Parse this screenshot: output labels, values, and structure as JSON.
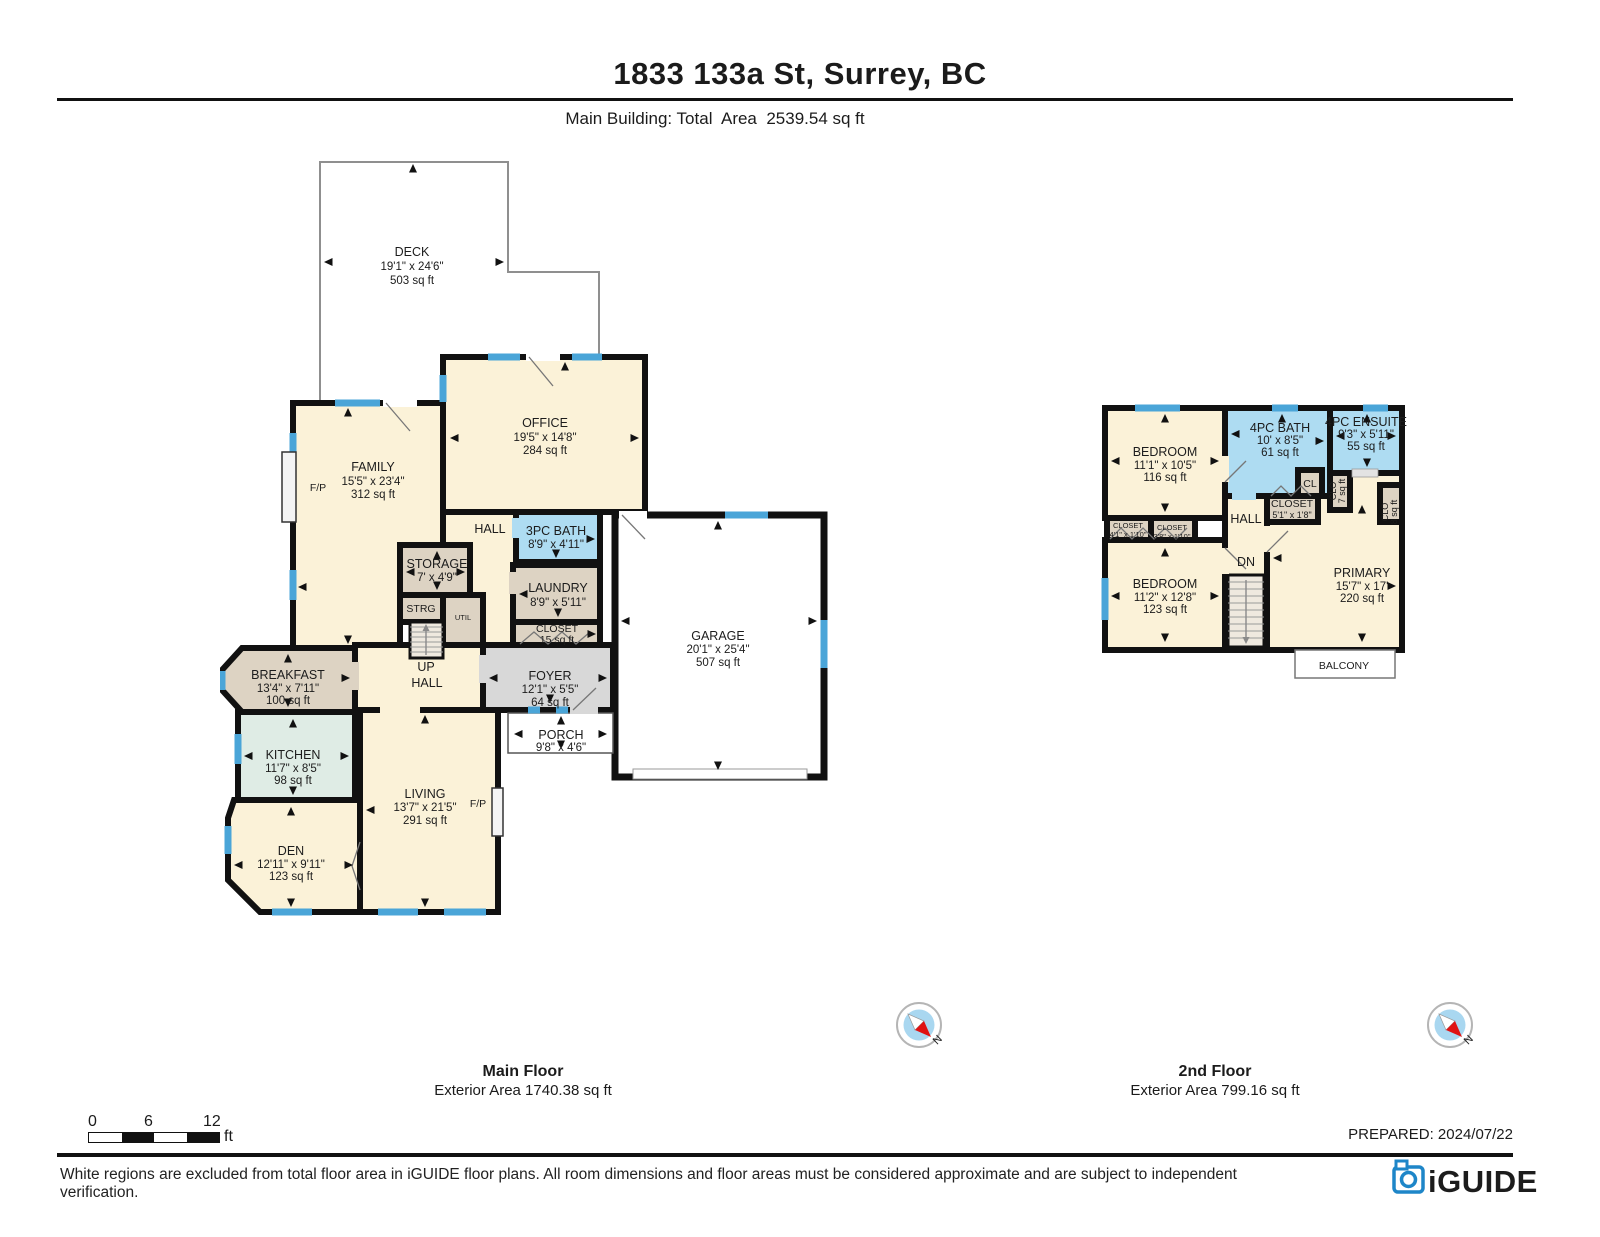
{
  "header": {
    "title": "1833 133a St, Surrey, BC",
    "subtitle": "Main Building: Total  Area  2539.54 sq ft"
  },
  "main_floor": {
    "title": "Main Floor",
    "area": "Exterior Area 1740.38 sq ft",
    "rooms": {
      "deck": {
        "name": "DECK",
        "dims": "19'1\" x 24'6\"",
        "area": "503 sq ft"
      },
      "office": {
        "name": "OFFICE",
        "dims": "19'5\" x 14'8\"",
        "area": "284 sq ft"
      },
      "family": {
        "name": "FAMILY",
        "dims": "15'5\" x 23'4\"",
        "area": "312 sq ft"
      },
      "hall_upper": {
        "name": "HALL"
      },
      "bath3pc": {
        "name": "3PC BATH",
        "dims": "8'9\" x 4'11\""
      },
      "storage": {
        "name": "STORAGE",
        "dims": "7' x 4'9\""
      },
      "laundry": {
        "name": "LAUNDRY",
        "dims": "8'9\" x 5'11\""
      },
      "strg": {
        "name": "STRG"
      },
      "util": {
        "name": "UTIL"
      },
      "closet": {
        "name": "CLOSET",
        "area": "15 sq ft"
      },
      "up": {
        "name": "UP"
      },
      "hall_lower": {
        "name": "HALL"
      },
      "foyer": {
        "name": "FOYER",
        "dims": "12'1\" x 5'5\"",
        "area": "64 sq ft"
      },
      "breakfast": {
        "name": "BREAKFAST",
        "dims": "13'4\" x 7'11\"",
        "area": "100 sq ft"
      },
      "porch": {
        "name": "PORCH",
        "dims": "9'8\" x 4'6\""
      },
      "garage": {
        "name": "GARAGE",
        "dims": "20'1\" x 25'4\"",
        "area": "507 sq ft"
      },
      "kitchen": {
        "name": "KITCHEN",
        "dims": "11'7\" x 8'5\"",
        "area": "98 sq ft"
      },
      "living": {
        "name": "LIVING",
        "dims": "13'7\" x 21'5\"",
        "area": "291 sq ft"
      },
      "den": {
        "name": "DEN",
        "dims": "12'11\" x 9'11\"",
        "area": "123 sq ft"
      },
      "fp_family": {
        "name": "F/P"
      },
      "fp_living": {
        "name": "F/P"
      }
    }
  },
  "second_floor": {
    "title": "2nd Floor",
    "area": "Exterior Area 799.16 sq ft",
    "rooms": {
      "bedroom1": {
        "name": "BEDROOM",
        "dims": "11'1\" x 10'5\"",
        "area": "116 sq ft"
      },
      "bath4pc": {
        "name": "4PC BATH",
        "dims": "10' x 8'5\"",
        "area": "61 sq ft"
      },
      "ensuite": {
        "name": "4PC ENSUITE",
        "dims": "9'3\" x 5'11\"",
        "area": "55 sq ft"
      },
      "cl": {
        "name": "CL"
      },
      "clo7": {
        "name": "CLO",
        "area": "7 sq ft"
      },
      "closet_hall": {
        "name": "CLOSET",
        "dims": "5'1\" x 1'8\""
      },
      "hall": {
        "name": "HALL"
      },
      "closet41": {
        "name": "CLOSET",
        "dims": "4'1\" x 1'10\""
      },
      "closet38": {
        "name": "CLOSET",
        "dims": "3'8\" x 1'10\""
      },
      "bedroom2": {
        "name": "BEDROOM",
        "dims": "11'2\" x 12'8\"",
        "area": "123 sq ft"
      },
      "dn": {
        "name": "DN"
      },
      "primary": {
        "name": "PRIMARY",
        "dims": "15'7\" x 17'",
        "area": "220 sq ft"
      },
      "clo8": {
        "name": "CLO",
        "area": "8 sq ft"
      },
      "balcony": {
        "name": "BALCONY"
      }
    }
  },
  "compass": {
    "north_label": "N"
  },
  "scale_bar": {
    "zero": "0",
    "six": "6",
    "twelve": "12",
    "unit": "ft"
  },
  "footer": {
    "prepared": "PREPARED: 2024/07/22",
    "disclaimer": "White regions are excluded from total floor area in iGUIDE floor plans. All room dimensions and floor areas must be considered approximate and are subject to independent verification.",
    "brand": "iGUIDE"
  },
  "colors": {
    "wall": "#111111",
    "window": "#4aa5d8",
    "room_cream": "#fbf2d8",
    "room_tan": "#ddd3c3",
    "room_green": "#dfece5",
    "bath_blue": "#aedcf2",
    "foyer_gray": "#d8d8d8",
    "brand_blue": "#1e86c8"
  }
}
